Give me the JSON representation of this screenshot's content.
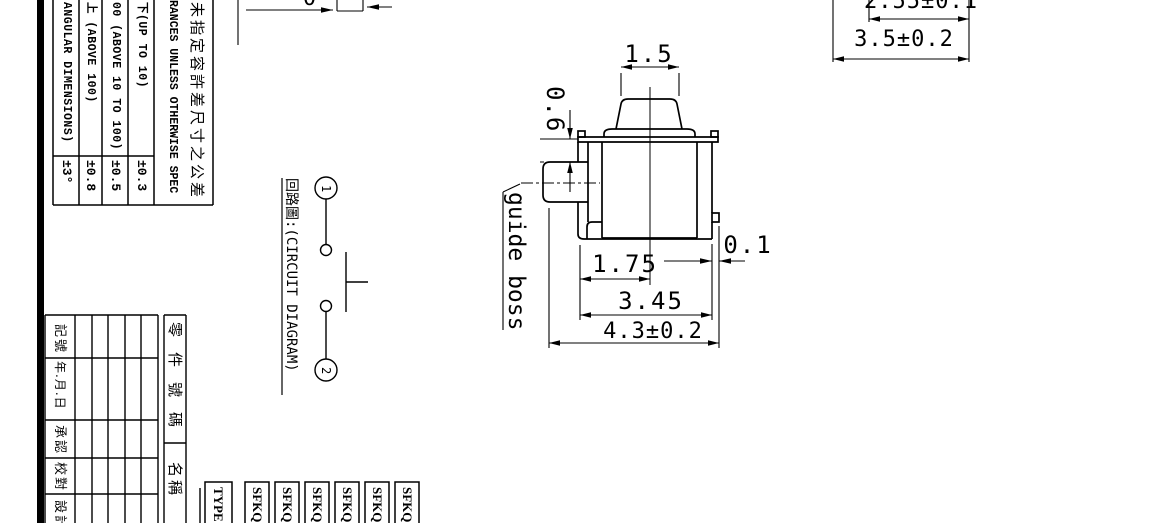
{
  "sheet": {
    "background": "#ffffff",
    "line_color": "#000000"
  },
  "tolerance_table": {
    "header_cn": "未指定容許差尺寸之公差",
    "header_en": "RANCES UNLESS OTHERWISE SPEC",
    "rows": [
      {
        "label": "下(UP TO 10)",
        "value": "±0.3"
      },
      {
        "label": "00 (ABOVE 10 TO 100)",
        "value": "±0.5"
      },
      {
        "label": "上 (ABOVE 100)",
        "value": "±0.8"
      },
      {
        "label": "ANGULAR DIMENSIONS)",
        "value": "±3°"
      }
    ]
  },
  "revision_table": {
    "row_labels": [
      "記號",
      "年.月.日",
      "承認",
      "校對",
      "設計"
    ],
    "part_no_label": "零件號碼",
    "name_label": "名稱"
  },
  "type_table": {
    "type_label": "TYPE",
    "models": [
      "SFKQ",
      "SFKQ",
      "SFKQ",
      "SFKQ",
      "SFKQ",
      "SFKQ"
    ]
  },
  "circuit": {
    "title": "回路圖:(CIRCUIT DIAGRAM)",
    "terminal_1": "1",
    "terminal_2": "2"
  },
  "main_view": {
    "dim_top_width": "1.5",
    "dim_boss_height": "0.6",
    "boss_label": "guide boss",
    "dim_half_width": "1.75",
    "dim_body_width": "3.45",
    "dim_overall_width": "4.3±0.2",
    "dim_tab": "0.1"
  },
  "top_view": {
    "dim_inner": "2.55±0.1",
    "dim_outer": "3.5±0.2",
    "dim_partial": "0"
  }
}
